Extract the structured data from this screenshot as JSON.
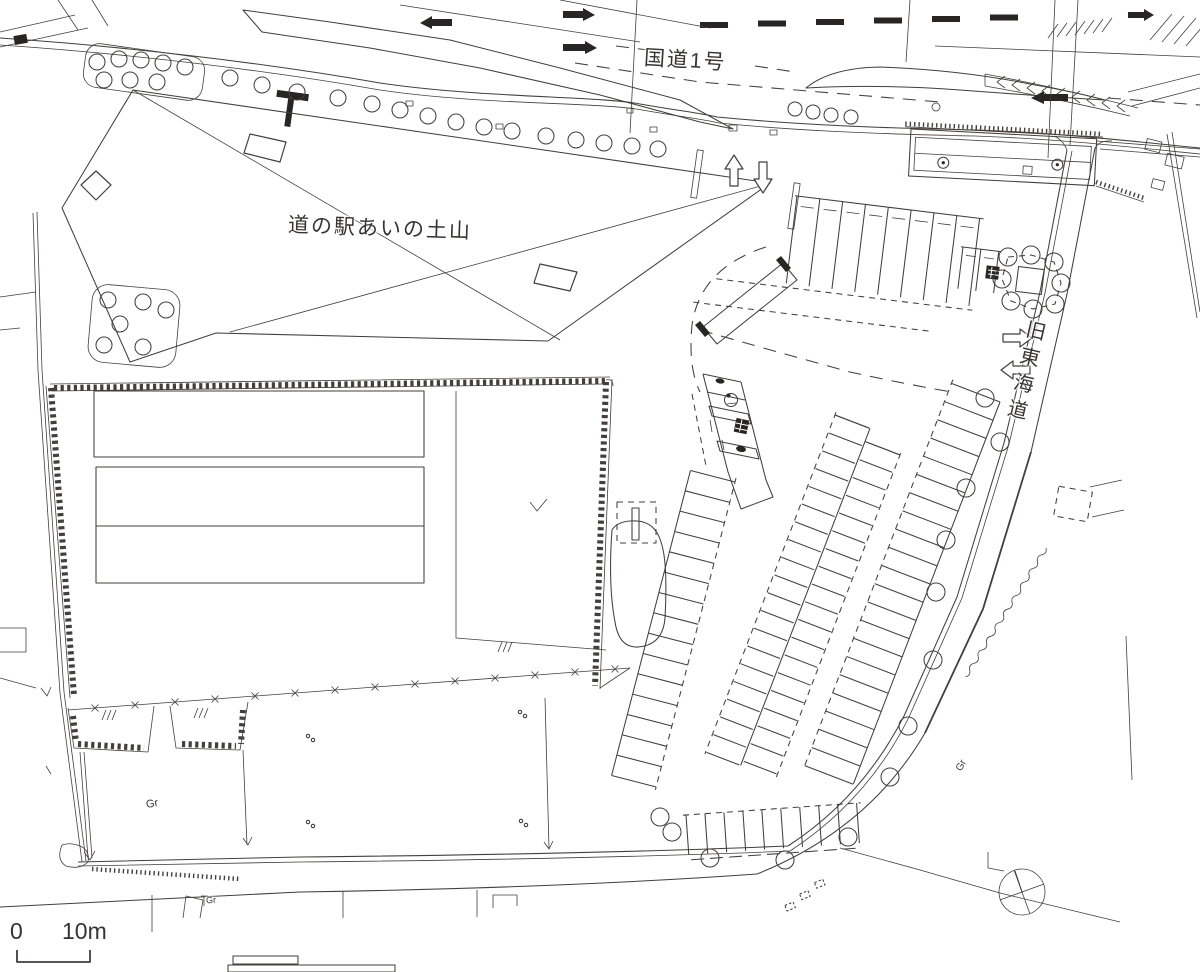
{
  "labels": {
    "national_route": "国道1号",
    "roadside_station": "道の駅あいの土山",
    "old_tokaido": "旧東海道",
    "ground_left": "Gr",
    "ground_right": "Gr",
    "ground_bottom": "Gr"
  },
  "scale_bar": {
    "zero": "0",
    "ten_meters": "10m"
  },
  "icons": {
    "north_arrow": "compass-north-arrow",
    "accessible_stall": "wheelchair-marking",
    "tree": "circle-tree-symbol",
    "grass": "grass-tuft-symbol"
  },
  "colors": {
    "ink": "#443e3e",
    "bg": "#ffffff",
    "walk": "#c9c6c4",
    "blk": "#2a2525"
  }
}
